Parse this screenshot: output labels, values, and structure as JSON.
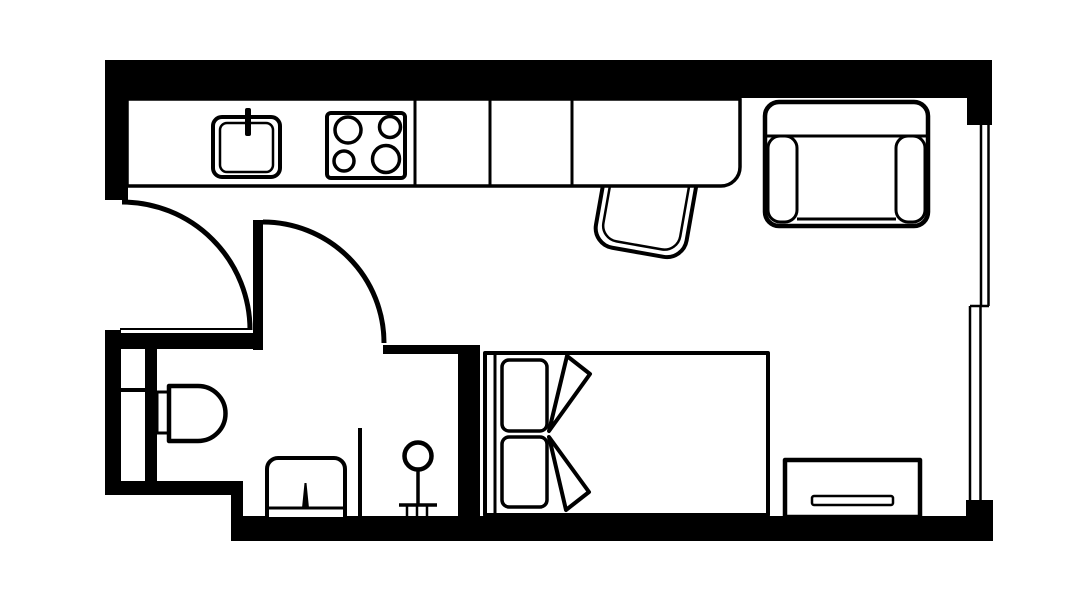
{
  "canvas": {
    "w": 1092,
    "h": 614,
    "bg": "#ffffff",
    "ink": "#000000"
  },
  "plan": {
    "kind": "studio-apartment-floor-plan",
    "shapes": [
      {
        "type": "rect",
        "name": "wall-top",
        "x": 105,
        "y": 60,
        "w": 885,
        "h": 38,
        "fill": "#000000"
      },
      {
        "type": "rect",
        "name": "wall-top-right-corner",
        "x": 967,
        "y": 60,
        "w": 25,
        "h": 65,
        "fill": "#000000"
      },
      {
        "type": "rect",
        "name": "wall-left-upper",
        "x": 105,
        "y": 60,
        "w": 23,
        "h": 140,
        "fill": "#000000"
      },
      {
        "type": "rect",
        "name": "wall-left-lower",
        "x": 105,
        "y": 330,
        "w": 16,
        "h": 163,
        "fill": "#000000"
      },
      {
        "type": "line",
        "name": "bathroom-top-wall-edge",
        "x1": 120,
        "y1": 329,
        "x2": 252,
        "y2": 329,
        "sw": 2
      },
      {
        "type": "rect",
        "name": "wall-bathroom-top",
        "x": 108,
        "y": 333,
        "w": 154,
        "h": 16,
        "fill": "#000000"
      },
      {
        "type": "rect",
        "name": "wall-bathroom-plumbing",
        "x": 145,
        "y": 349,
        "w": 12,
        "h": 134,
        "fill": "#000000"
      },
      {
        "type": "rect",
        "name": "duct-divider",
        "x": 121,
        "y": 388,
        "w": 24,
        "h": 4,
        "fill": "#000000"
      },
      {
        "type": "rect",
        "name": "wall-bathroom-bottom",
        "x": 105,
        "y": 481,
        "w": 138,
        "h": 14,
        "fill": "#000000"
      },
      {
        "type": "rect",
        "name": "wall-step",
        "x": 231,
        "y": 481,
        "w": 12,
        "h": 60,
        "fill": "#000000"
      },
      {
        "type": "rect",
        "name": "wall-bottom",
        "x": 231,
        "y": 516,
        "w": 762,
        "h": 25,
        "fill": "#000000"
      },
      {
        "type": "rect",
        "name": "wall-bottom-right-corner",
        "x": 966,
        "y": 500,
        "w": 27,
        "h": 41,
        "fill": "#000000"
      },
      {
        "type": "rect",
        "name": "wall-bathroom-right-horizontal",
        "x": 383,
        "y": 345,
        "w": 77,
        "h": 9,
        "fill": "#000000"
      },
      {
        "type": "rect",
        "name": "wall-bathroom-right-vertical",
        "x": 458,
        "y": 345,
        "w": 22,
        "h": 196,
        "fill": "#000000"
      },
      {
        "type": "line",
        "name": "window-upper-outer",
        "x1": 988.5,
        "y1": 125,
        "x2": 988.5,
        "y2": 306,
        "sw": 2.5
      },
      {
        "type": "line",
        "name": "window-upper-inner",
        "x1": 981,
        "y1": 125,
        "x2": 981,
        "y2": 306,
        "sw": 2.5
      },
      {
        "type": "line",
        "name": "window-jog",
        "x1": 970,
        "y1": 306,
        "x2": 989,
        "y2": 306,
        "sw": 2.5
      },
      {
        "type": "line",
        "name": "window-lower-outer",
        "x1": 980.5,
        "y1": 306,
        "x2": 980.5,
        "y2": 500,
        "sw": 2.5
      },
      {
        "type": "line",
        "name": "window-lower-inner",
        "x1": 970,
        "y1": 306,
        "x2": 970,
        "y2": 500,
        "sw": 2.5
      },
      {
        "type": "path",
        "name": "entry-door-swing-arc",
        "d": "M122,202 A128,128 0 0 1 250,330",
        "sw": 5
      },
      {
        "type": "rect",
        "name": "bathroom-door-leaf",
        "x": 253,
        "y": 220,
        "w": 10,
        "h": 130,
        "fill": "#000000"
      },
      {
        "type": "path",
        "name": "bathroom-door-swing-arc",
        "d": "M263,222 A121,121 0 0 1 384,343",
        "sw": 5
      },
      {
        "type": "rect",
        "name": "desk-chair-outer",
        "x": 600,
        "y": 158,
        "w": 92,
        "h": 95,
        "rx": 20,
        "sw": 4,
        "fill": "#ffffff",
        "rotate": "10 646 206"
      },
      {
        "type": "rect",
        "name": "desk-chair-inner",
        "x": 607,
        "y": 165,
        "w": 78,
        "h": 81,
        "rx": 16,
        "sw": 2.5,
        "fill": "none",
        "rotate": "10 646 206"
      },
      {
        "type": "path",
        "name": "kitchen-counter-outline",
        "d": "M127,99 H740 V167 A19,19 0 0 1 721,186 H127 Z",
        "sw": 3.5,
        "fill": "#ffffff"
      },
      {
        "type": "line",
        "name": "counter-divider-1",
        "x1": 415,
        "y1": 99,
        "x2": 415,
        "y2": 186,
        "sw": 3
      },
      {
        "type": "line",
        "name": "counter-divider-2",
        "x1": 490,
        "y1": 99,
        "x2": 490,
        "y2": 186,
        "sw": 3
      },
      {
        "type": "line",
        "name": "counter-divider-3",
        "x1": 572,
        "y1": 99,
        "x2": 572,
        "y2": 186,
        "sw": 3
      },
      {
        "type": "rect",
        "name": "kitchen-sink-outer",
        "x": 213,
        "y": 117,
        "w": 67,
        "h": 60,
        "rx": 9,
        "sw": 4,
        "fill": "#ffffff"
      },
      {
        "type": "rect",
        "name": "kitchen-sink-inner",
        "x": 220,
        "y": 123,
        "w": 53,
        "h": 49,
        "rx": 7,
        "sw": 2.5,
        "fill": "none"
      },
      {
        "type": "rect",
        "name": "sink-faucet",
        "x": 245,
        "y": 108,
        "w": 6,
        "h": 28,
        "rx": 2,
        "fill": "#000000"
      },
      {
        "type": "rect",
        "name": "stove-cooktop",
        "x": 327,
        "y": 113,
        "w": 78,
        "h": 65,
        "rx": 4,
        "sw": 4,
        "fill": "#ffffff"
      },
      {
        "type": "circle",
        "name": "stove-burner-top-left",
        "cx": 348,
        "cy": 130,
        "r": 13,
        "sw": 3.5,
        "fill": "none"
      },
      {
        "type": "circle",
        "name": "stove-burner-top-right",
        "cx": 390,
        "cy": 127,
        "r": 10.5,
        "sw": 3.5,
        "fill": "none"
      },
      {
        "type": "circle",
        "name": "stove-burner-bottom-left",
        "cx": 344,
        "cy": 161,
        "r": 10,
        "sw": 3.5,
        "fill": "none"
      },
      {
        "type": "circle",
        "name": "stove-burner-bottom-right",
        "cx": 386,
        "cy": 159,
        "r": 13.5,
        "sw": 3.5,
        "fill": "none"
      },
      {
        "type": "rect",
        "name": "armchair-body",
        "x": 765,
        "y": 102,
        "w": 163,
        "h": 124,
        "rx": 14,
        "sw": 4.5,
        "fill": "#ffffff"
      },
      {
        "type": "line",
        "name": "armchair-back-seam",
        "x1": 767,
        "y1": 136,
        "x2": 926,
        "y2": 136,
        "sw": 3
      },
      {
        "type": "rect",
        "name": "armchair-armrest-left",
        "x": 768,
        "y": 136,
        "w": 29,
        "h": 86,
        "rx": 12,
        "sw": 3,
        "fill": "none"
      },
      {
        "type": "rect",
        "name": "armchair-armrest-right",
        "x": 896,
        "y": 136,
        "w": 29,
        "h": 86,
        "rx": 12,
        "sw": 3,
        "fill": "none"
      },
      {
        "type": "line",
        "name": "armchair-seat-front",
        "x1": 797,
        "y1": 219,
        "x2": 896,
        "y2": 219,
        "sw": 3
      },
      {
        "type": "rect",
        "name": "bed-frame",
        "x": 485,
        "y": 353,
        "w": 283,
        "h": 162,
        "sw": 4,
        "fill": "#ffffff"
      },
      {
        "type": "line",
        "name": "bed-headboard",
        "x1": 495,
        "y1": 353,
        "x2": 495,
        "y2": 515,
        "sw": 3
      },
      {
        "type": "rect",
        "name": "bed-pillow-top",
        "x": 502,
        "y": 360,
        "w": 45,
        "h": 71,
        "rx": 7,
        "sw": 3.5,
        "fill": "#ffffff"
      },
      {
        "type": "rect",
        "name": "bed-pillow-bottom",
        "x": 502,
        "y": 437,
        "w": 45,
        "h": 70,
        "rx": 7,
        "sw": 3.5,
        "fill": "#ffffff"
      },
      {
        "type": "polygon",
        "name": "bed-duvet-fold-top",
        "points": "567,356 590,374 549,431",
        "sw": 4,
        "fill": "#ffffff"
      },
      {
        "type": "polygon",
        "name": "bed-duvet-fold-bottom",
        "points": "549,437 589,492 566,510",
        "sw": 4,
        "fill": "#ffffff"
      },
      {
        "type": "rect",
        "name": "dresser",
        "x": 785,
        "y": 460,
        "w": 135,
        "h": 57,
        "sw": 4.5,
        "fill": "#ffffff"
      },
      {
        "type": "rect",
        "name": "dresser-handle-slot",
        "x": 812,
        "y": 496,
        "w": 81,
        "h": 9,
        "rx": 2,
        "sw": 2.5,
        "fill": "none"
      },
      {
        "type": "rect",
        "name": "toilet-tank",
        "x": 157,
        "y": 392,
        "w": 12,
        "h": 41,
        "sw": 3,
        "fill": "#ffffff"
      },
      {
        "type": "path",
        "name": "toilet-bowl",
        "d": "M169,386 H198 A27.5,27.5 0 0 1 225.5,413.5 A27.5,27.5 0 0 1 198,441 H169 Z",
        "sw": 4.5,
        "fill": "#ffffff"
      },
      {
        "type": "path",
        "name": "vanity-basin",
        "d": "M267,517 V469 A11,11 0 0 1 278,458 H334 A11,11 0 0 1 345,469 V517",
        "sw": 4,
        "fill": "#ffffff"
      },
      {
        "type": "line",
        "name": "vanity-front-edge",
        "x1": 268,
        "y1": 508,
        "x2": 344,
        "y2": 508,
        "sw": 3
      },
      {
        "type": "polygon",
        "name": "vanity-tap",
        "points": "302,508 304.5,483 306.5,483 309,508",
        "fill": "#000000"
      },
      {
        "type": "line",
        "name": "shower-partition",
        "x1": 360,
        "y1": 428,
        "x2": 360,
        "y2": 520,
        "sw": 4
      },
      {
        "type": "circle",
        "name": "shower-head",
        "cx": 418,
        "cy": 456,
        "r": 13.5,
        "sw": 4.5,
        "fill": "#ffffff"
      },
      {
        "type": "line",
        "name": "shower-riser",
        "x1": 418,
        "y1": 470,
        "x2": 418,
        "y2": 505,
        "sw": 3.5
      },
      {
        "type": "line",
        "name": "shower-rail",
        "x1": 399,
        "y1": 505,
        "x2": 437,
        "y2": 505,
        "sw": 3.5
      },
      {
        "type": "line",
        "name": "shower-rail-leg-left",
        "x1": 407,
        "y1": 505,
        "x2": 407,
        "y2": 516,
        "sw": 2.5
      },
      {
        "type": "line",
        "name": "shower-rail-leg-mid",
        "x1": 417,
        "y1": 505,
        "x2": 417,
        "y2": 516,
        "sw": 2.5
      },
      {
        "type": "line",
        "name": "shower-rail-leg-right",
        "x1": 427,
        "y1": 505,
        "x2": 427,
        "y2": 516,
        "sw": 2.5
      }
    ]
  }
}
